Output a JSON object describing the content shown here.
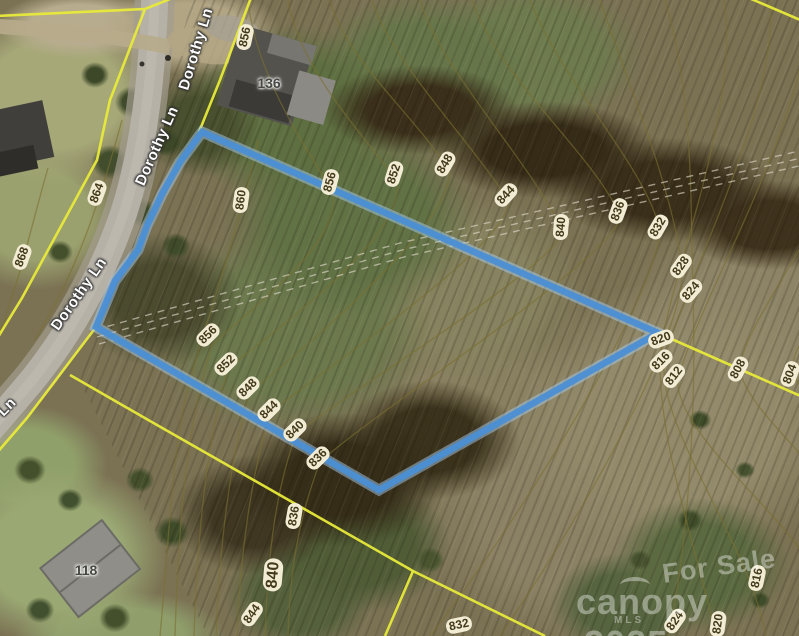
{
  "map": {
    "road_labels": [
      {
        "text": "Dorothy Ln",
        "x": 196,
        "y": 49,
        "rot": -73
      },
      {
        "text": "Dorothy Ln",
        "x": 157,
        "y": 146,
        "rot": -66
      },
      {
        "text": "Dorothy Ln",
        "x": 79,
        "y": 294,
        "rot": -55
      },
      {
        "text": "Ln",
        "x": 7,
        "y": 407,
        "rot": -45
      }
    ],
    "house_numbers": [
      {
        "text": "136",
        "x": 269,
        "y": 83
      },
      {
        "text": "118",
        "x": 86,
        "y": 570
      }
    ],
    "contour_labels": [
      {
        "text": "856",
        "x": 245,
        "y": 37,
        "rot": -78
      },
      {
        "text": "860",
        "x": 241,
        "y": 200,
        "rot": -82
      },
      {
        "text": "864",
        "x": 97,
        "y": 193,
        "rot": -70
      },
      {
        "text": "868",
        "x": 22,
        "y": 257,
        "rot": -70
      },
      {
        "text": "856",
        "x": 330,
        "y": 182,
        "rot": -75
      },
      {
        "text": "852",
        "x": 394,
        "y": 174,
        "rot": -72
      },
      {
        "text": "848",
        "x": 445,
        "y": 164,
        "rot": -60
      },
      {
        "text": "844",
        "x": 506,
        "y": 195,
        "rot": -48
      },
      {
        "text": "840",
        "x": 561,
        "y": 227,
        "rot": -85
      },
      {
        "text": "836",
        "x": 618,
        "y": 211,
        "rot": -70
      },
      {
        "text": "832",
        "x": 658,
        "y": 227,
        "rot": -60
      },
      {
        "text": "828",
        "x": 681,
        "y": 266,
        "rot": -55
      },
      {
        "text": "824",
        "x": 691,
        "y": 291,
        "rot": -50
      },
      {
        "text": "820",
        "x": 661,
        "y": 339,
        "rot": -20
      },
      {
        "text": "816",
        "x": 661,
        "y": 361,
        "rot": -45
      },
      {
        "text": "812",
        "x": 674,
        "y": 376,
        "rot": -52
      },
      {
        "text": "808",
        "x": 738,
        "y": 369,
        "rot": -62
      },
      {
        "text": "804",
        "x": 790,
        "y": 374,
        "rot": -70
      },
      {
        "text": "856",
        "x": 208,
        "y": 335,
        "rot": -45
      },
      {
        "text": "852",
        "x": 226,
        "y": 364,
        "rot": -45
      },
      {
        "text": "848",
        "x": 248,
        "y": 388,
        "rot": -45
      },
      {
        "text": "844",
        "x": 269,
        "y": 410,
        "rot": -45
      },
      {
        "text": "840",
        "x": 295,
        "y": 430,
        "rot": -45
      },
      {
        "text": "836",
        "x": 318,
        "y": 458,
        "rot": -45
      },
      {
        "text": "836",
        "x": 294,
        "y": 516,
        "rot": -80
      },
      {
        "text": "840",
        "x": 273,
        "y": 575,
        "rot": -85,
        "big": true
      },
      {
        "text": "844",
        "x": 252,
        "y": 614,
        "rot": -55
      },
      {
        "text": "832",
        "x": 459,
        "y": 625,
        "rot": -12
      },
      {
        "text": "824",
        "x": 675,
        "y": 621,
        "rot": -55
      },
      {
        "text": "820",
        "x": 718,
        "y": 624,
        "rot": -82
      },
      {
        "text": "816",
        "x": 757,
        "y": 578,
        "rot": -78
      }
    ],
    "watermark": {
      "for_sale": "For Sale",
      "brand": "canopy",
      "year": "2025",
      "mls": "MLS"
    },
    "colors": {
      "parcel": "#4b90d4",
      "parcel_halo": "#a5c9e9",
      "boundary": "#e8ea3a",
      "contour_line": "#7a7030",
      "label_pill": "#f2ecd4",
      "label_text": "#43391b",
      "road": "#b5b1a7",
      "watermark": "rgba(255,255,255,0.38)"
    }
  }
}
